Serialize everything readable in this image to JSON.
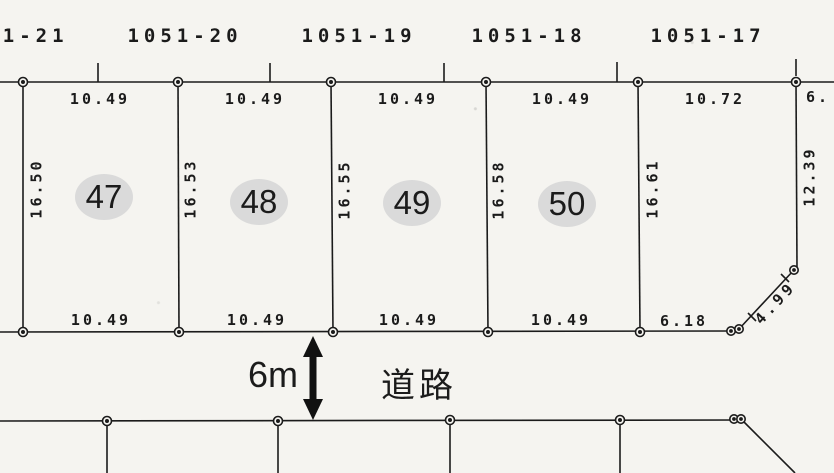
{
  "drawing_type": "cadastral-land-plat",
  "colors": {
    "background": "#f5f4f0",
    "ink": "#1b1b1b",
    "plot_oval": "#dadada"
  },
  "upper_lots": {
    "labels": [
      "1051-21",
      "1051-20",
      "1051-19",
      "1051-18",
      "1051-17"
    ]
  },
  "top_edge_dims": [
    "10.49",
    "10.49",
    "10.49",
    "10.49",
    "10.72",
    "6."
  ],
  "side_dims": [
    "16.50",
    "16.53",
    "16.55",
    "16.58",
    "16.61"
  ],
  "right_side_dim": "12.39",
  "plot_numbers": [
    "47",
    "48",
    "49",
    "50"
  ],
  "bottom_edge_dims": [
    "10.49",
    "10.49",
    "10.49",
    "10.49",
    "6.18"
  ],
  "diagonal_dim": "4.99",
  "road": {
    "width_label": "6m",
    "name": "道路"
  }
}
